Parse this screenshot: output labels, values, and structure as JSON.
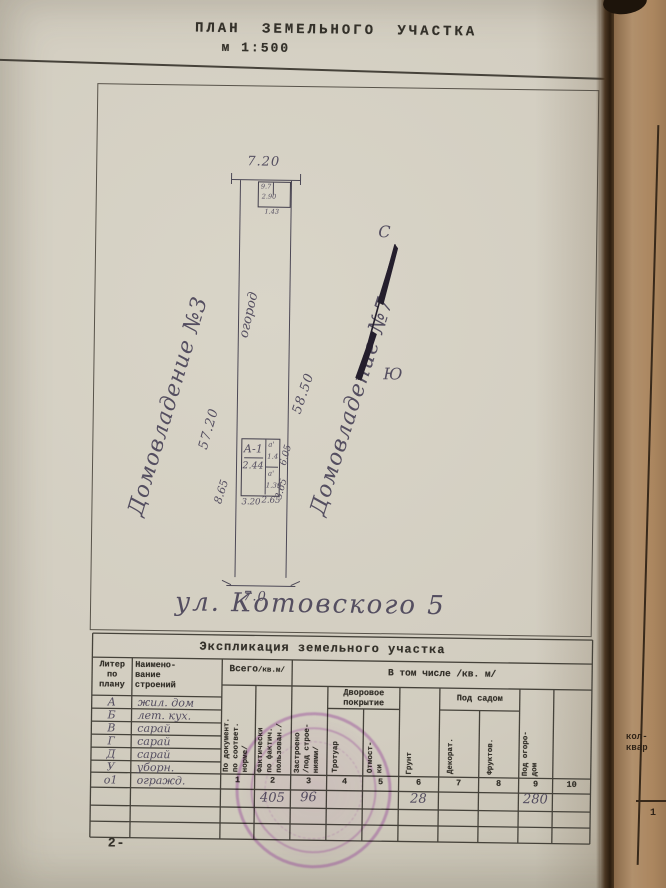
{
  "header": {
    "title": "ПЛАН  ЗЕМЕЛЬНОГО  УЧАСТКА",
    "scale": "м  1:500"
  },
  "plan": {
    "neighbor_left": "Домовладение №3",
    "neighbor_right": "Домовладение №7",
    "garden_label": "огород",
    "street_label": "ул. Котовского 5",
    "compass_north": "С",
    "compass_south": "Ю",
    "dim_top": "7.20",
    "dim_bottom": "7.0",
    "dim_left": "57.20",
    "dim_right": "58.50",
    "dim_house_left": "8.65",
    "dim_house_right_top": "6.05",
    "dim_house_right_bottom": "3.65",
    "dim_house_bottom_1": "3.20",
    "dim_house_bottom_2": "2.65",
    "top_structure": {
      "num_1": "9.7",
      "num_2": "2.90",
      "num_3": "1.43"
    },
    "house": {
      "liter": "А-1",
      "area": "2.44",
      "annex_top_liter": "а'",
      "annex_top_area": "1.4",
      "annex_bottom_liter": "а'",
      "annex_bottom_area": "1.39"
    }
  },
  "table": {
    "title": "Экспликация  земельного  участка",
    "col_liter": "Литер\nпо\nплану",
    "col_name": "Наимено-\nвание\nстроений",
    "col_total": "Всего",
    "col_total_unit": "/кв.м/",
    "col_included": "В том числе   /кв. м/",
    "sub_docs": "По документ.\nпо соответ.\nнорме/",
    "sub_fact": "Фактически\nпо фактич.\nпользован./",
    "sub_built": "Застроено\n/под строе-\nниями/",
    "grp_yard": "Дворовое\nпокрытие",
    "sub_sidewalk": "Тротуар",
    "sub_blind": "Отмост-\nки",
    "sub_ground": "Грунт",
    "grp_garden": "Под садом",
    "sub_decor": "Декорат.",
    "sub_fruit": "Фруктов.",
    "sub_veg": "Под огоро-\nдом",
    "col_numbers": [
      "1",
      "2",
      "3",
      "4",
      "5",
      "6",
      "7",
      "8",
      "9",
      "10"
    ],
    "rows": [
      {
        "liter": "А",
        "name": "жил. дом"
      },
      {
        "liter": "Б",
        "name": "лет. кух."
      },
      {
        "liter": "В",
        "name": "сарай"
      },
      {
        "liter": "Г",
        "name": "сарай"
      },
      {
        "liter": "Д",
        "name": "сарай"
      },
      {
        "liter": "У",
        "name": "уборн."
      },
      {
        "liter": "о1",
        "name": "огражд."
      }
    ],
    "values": {
      "fact_total": "405",
      "built": "96",
      "ground": "28",
      "vegetable": "280"
    }
  },
  "footer": {
    "page_number": "2-"
  },
  "adjacent_page": {
    "text_line1": "кол-",
    "text_line2": "квар",
    "number": "1"
  }
}
